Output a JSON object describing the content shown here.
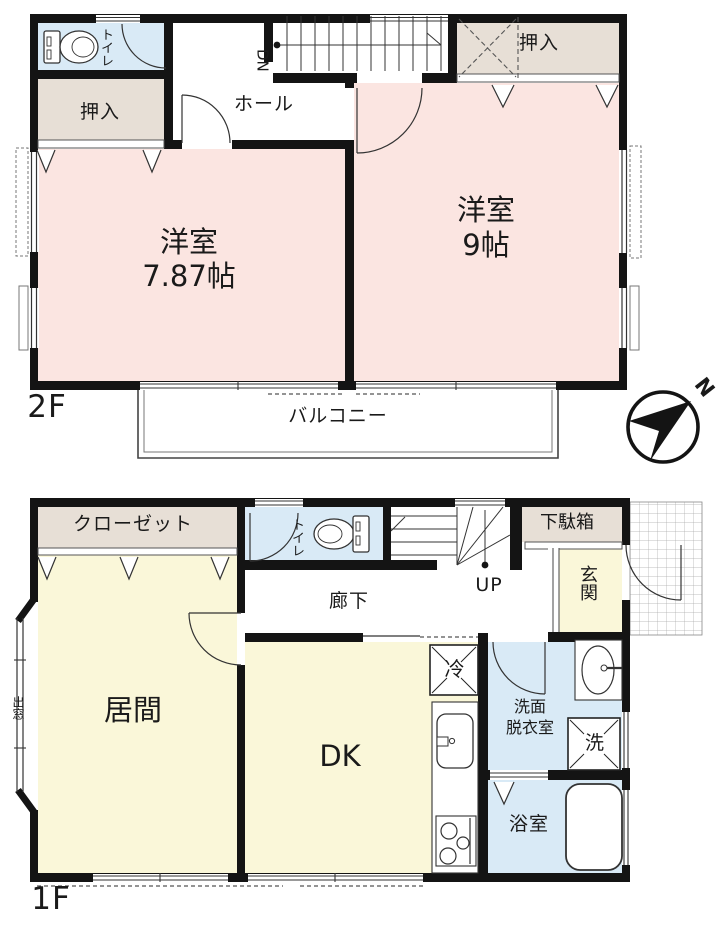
{
  "palette": {
    "wall": "#141414",
    "bedroom_pink": "#fbe5e1",
    "living_cream": "#faf7d9",
    "wet_blue": "#d9eaf6",
    "storage_beige": "#e7dfd6",
    "line_gray": "#555555"
  },
  "floor2": {
    "label": "2F",
    "toilet": "トイレ",
    "closet_left": "押入",
    "hall": "ホール",
    "stairs": "DN",
    "closet_right": "押入",
    "bedroom_left": {
      "name": "洋室",
      "size": "7.87帖"
    },
    "bedroom_right": {
      "name": "洋室",
      "size": "9帖"
    },
    "balcony": "バルコニー"
  },
  "floor1": {
    "label": "1F",
    "closet": "クローゼット",
    "toilet": "トイレ",
    "stairs": "UP",
    "shoe_cabinet": "下駄箱",
    "entrance": "玄関",
    "corridor": "廊下",
    "living": "居間",
    "bay_window": "出窓",
    "dining_kitchen": "DK",
    "refrigerator": "冷",
    "washroom": {
      "line1": "洗面",
      "line2": "脱衣室"
    },
    "washer": "洗",
    "bathroom": "浴室"
  },
  "compass": {
    "north": "N"
  }
}
